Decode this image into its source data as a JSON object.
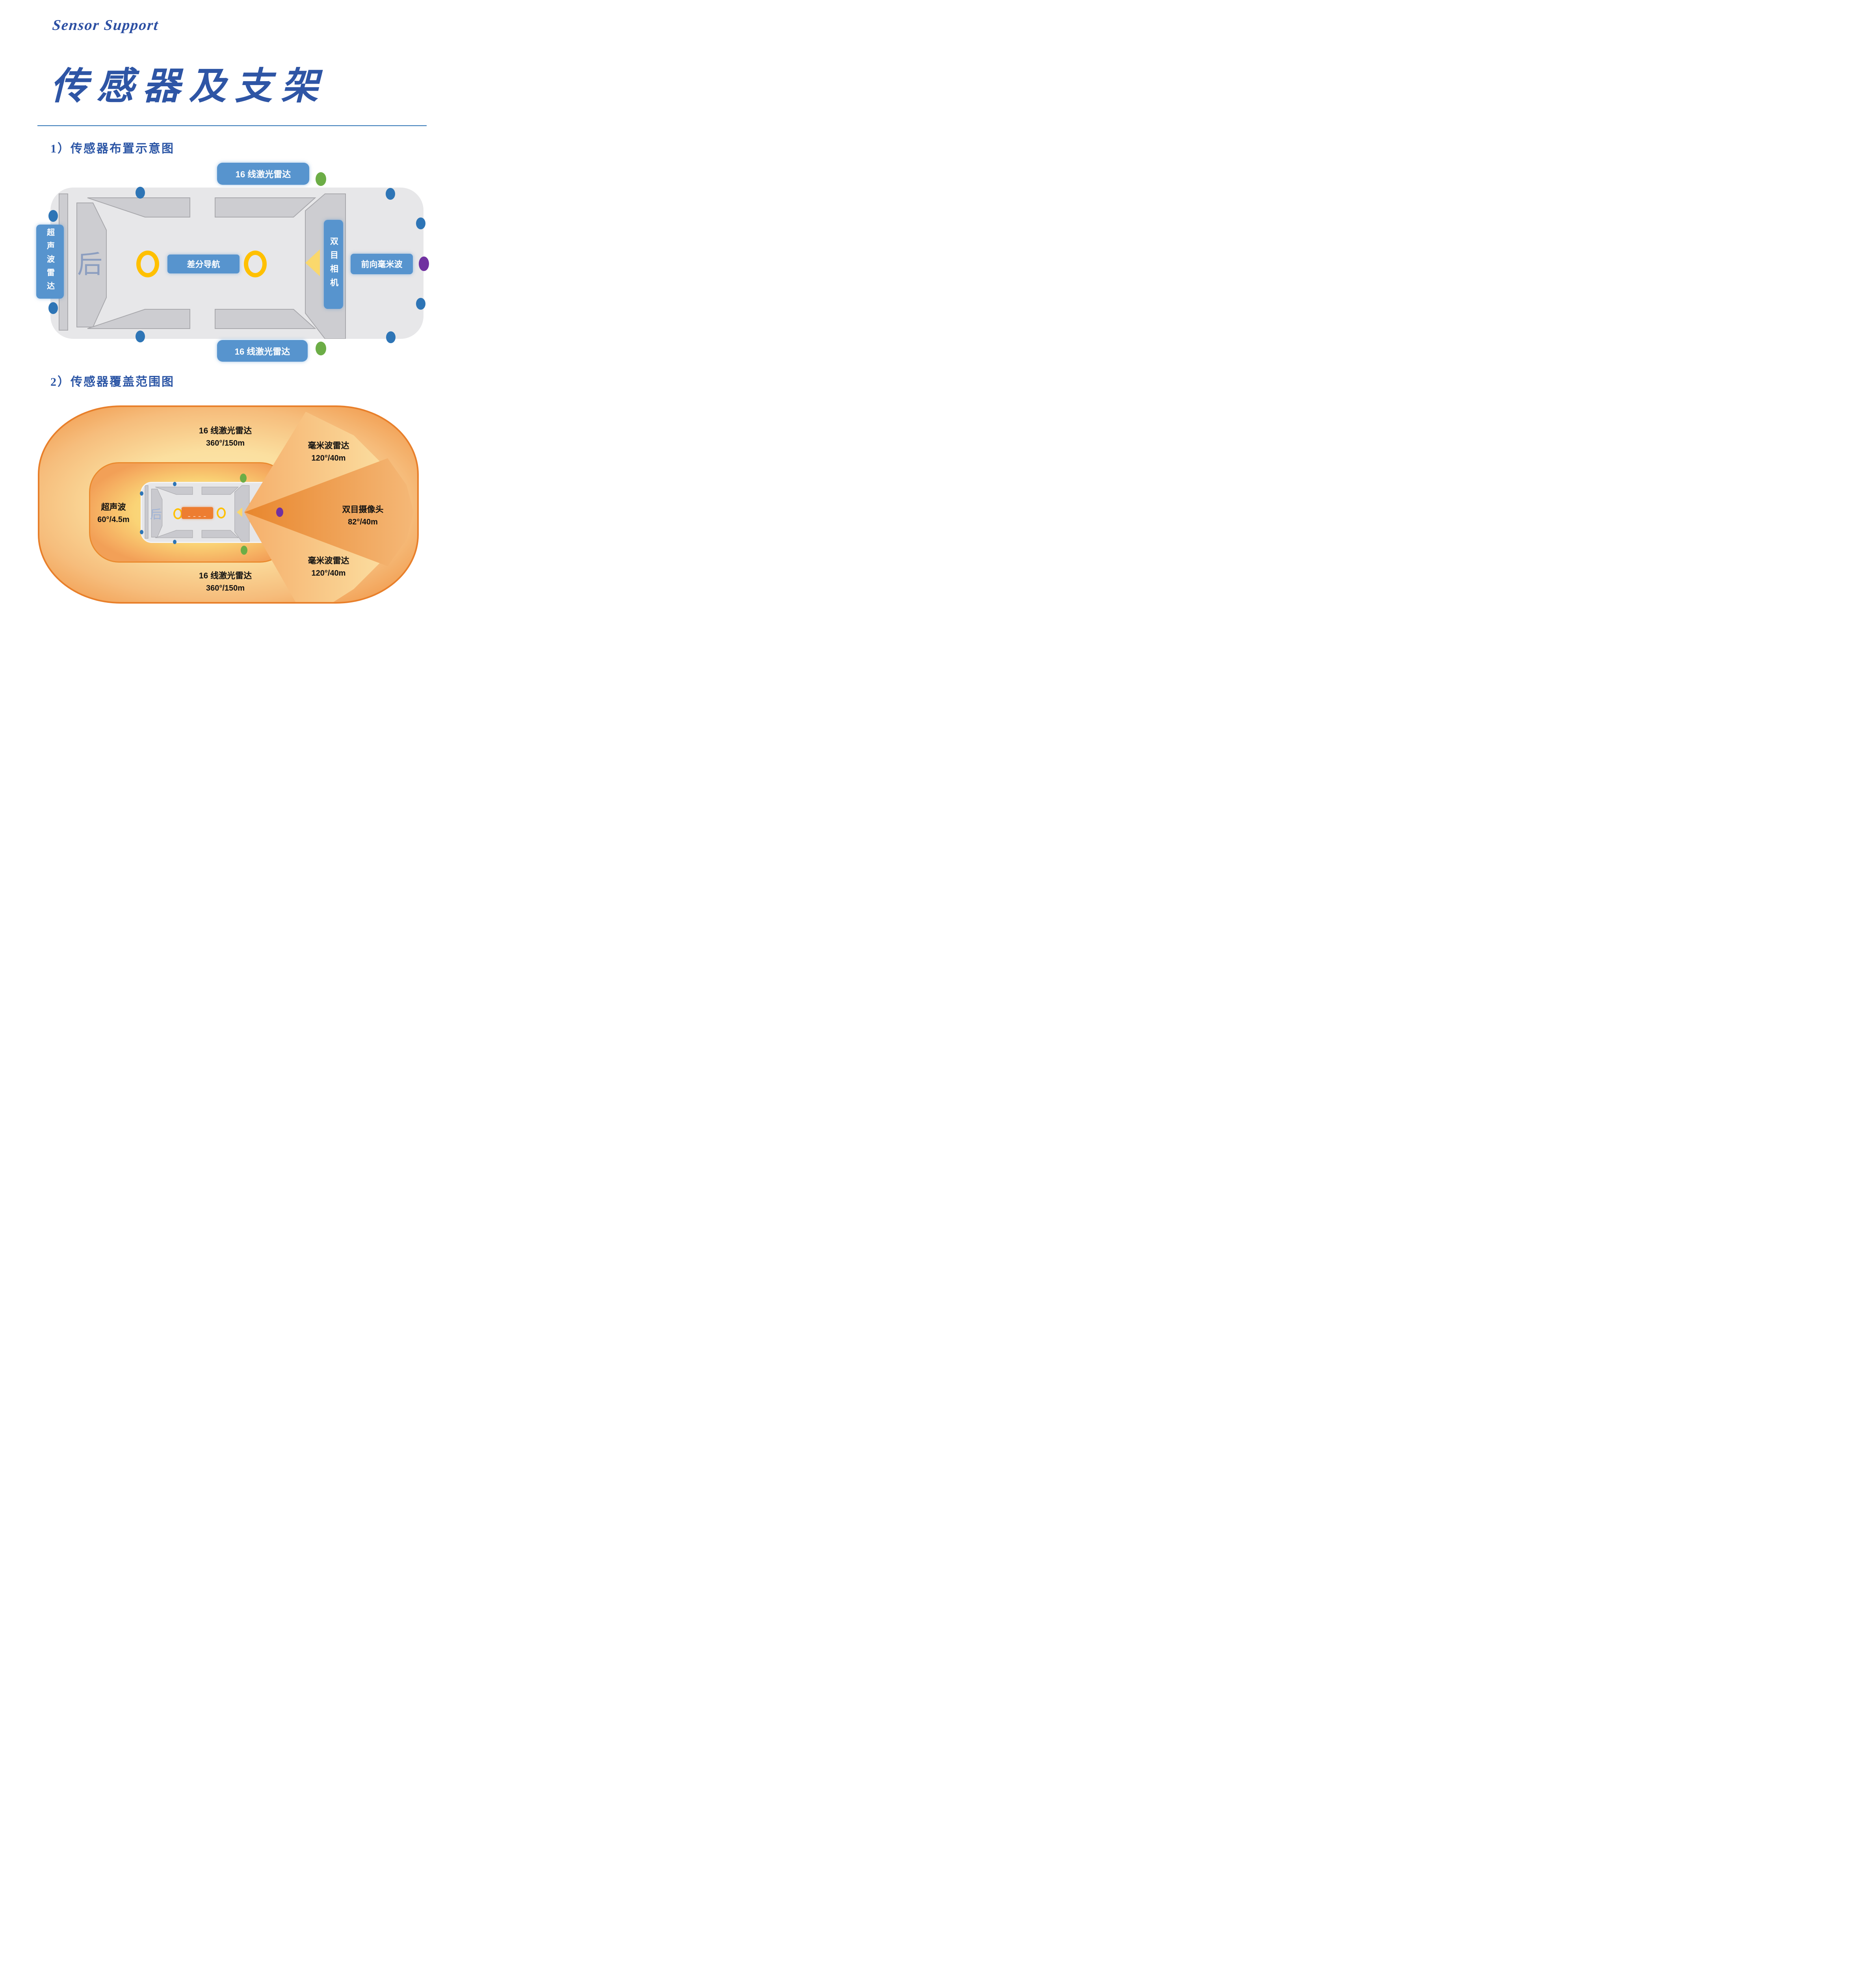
{
  "header": {
    "brand": "Sensor Support",
    "title": "传感器及支架"
  },
  "sections": {
    "layout_heading": "1）传感器布置示意图",
    "coverage_heading": "2）传感器覆盖范围图"
  },
  "layout_diagram": {
    "lidar_top_label": "16 线激光雷达",
    "lidar_bottom_label": "16 线激光雷达",
    "ultrasonic_label": "超声波雷达",
    "rear_marker": "后",
    "nav_label": "差分导航",
    "stereo_camera_label": "双目相机",
    "front_mmwave_label": "前向毫米波"
  },
  "coverage_diagram": {
    "lidar_top": {
      "name": "16 线激光雷达",
      "spec": "360°/150m"
    },
    "mmwave_top": {
      "name": "毫米波雷达",
      "spec": "120°/40m"
    },
    "ultrasonic": {
      "name": "超声波",
      "spec": "60°/4.5m"
    },
    "stereo_camera": {
      "name": "双目摄像头",
      "spec": "82°/40m"
    },
    "mmwave_bottom": {
      "name": "毫米波雷达",
      "spec": "120°/40m"
    },
    "lidar_bottom": {
      "name": "16 线激光雷达",
      "spec": "360°/150m"
    },
    "rear_marker": "后",
    "gnss_dashes": "– – – –"
  },
  "colors": {
    "label_blue": "#5794CE",
    "heading_blue": "#2B55A5",
    "mount_dot_blue": "#2E75B6",
    "lidar_dot_green": "#6CAD46",
    "camera_dot_purple": "#7030A0",
    "ring_yellow": "#FFC000",
    "cone_orange": "#E8862D",
    "body_gray": "#E7E7E9"
  }
}
